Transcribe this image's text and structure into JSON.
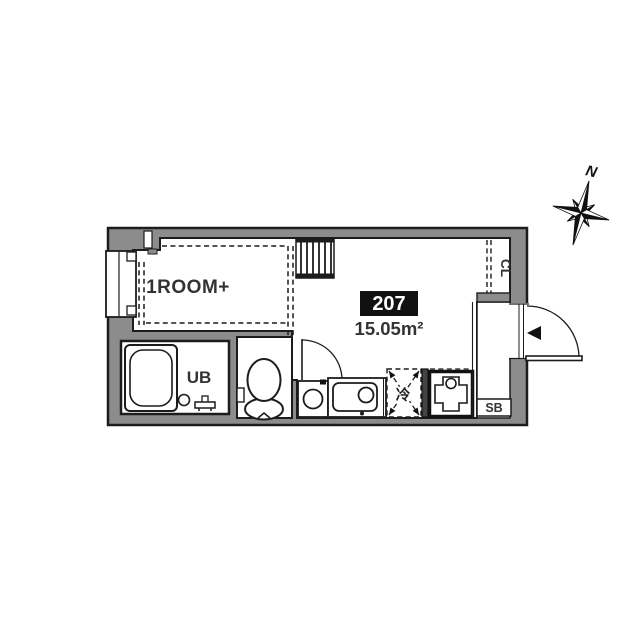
{
  "floor_plan": {
    "compass_label": "N",
    "unit_number": "207",
    "floor_area": "15.05m²",
    "room_label": "1ROOM+",
    "unit_bath_label": "UB",
    "closet_label": "CL",
    "shoe_box_label": "SB",
    "refrigerator_label": "冷"
  },
  "colors": {
    "background": "#ffffff",
    "wall_fill": "#8c8c8c",
    "line": "#1c1c1c",
    "badge_bg": "#111111",
    "badge_text": "#ffffff"
  }
}
